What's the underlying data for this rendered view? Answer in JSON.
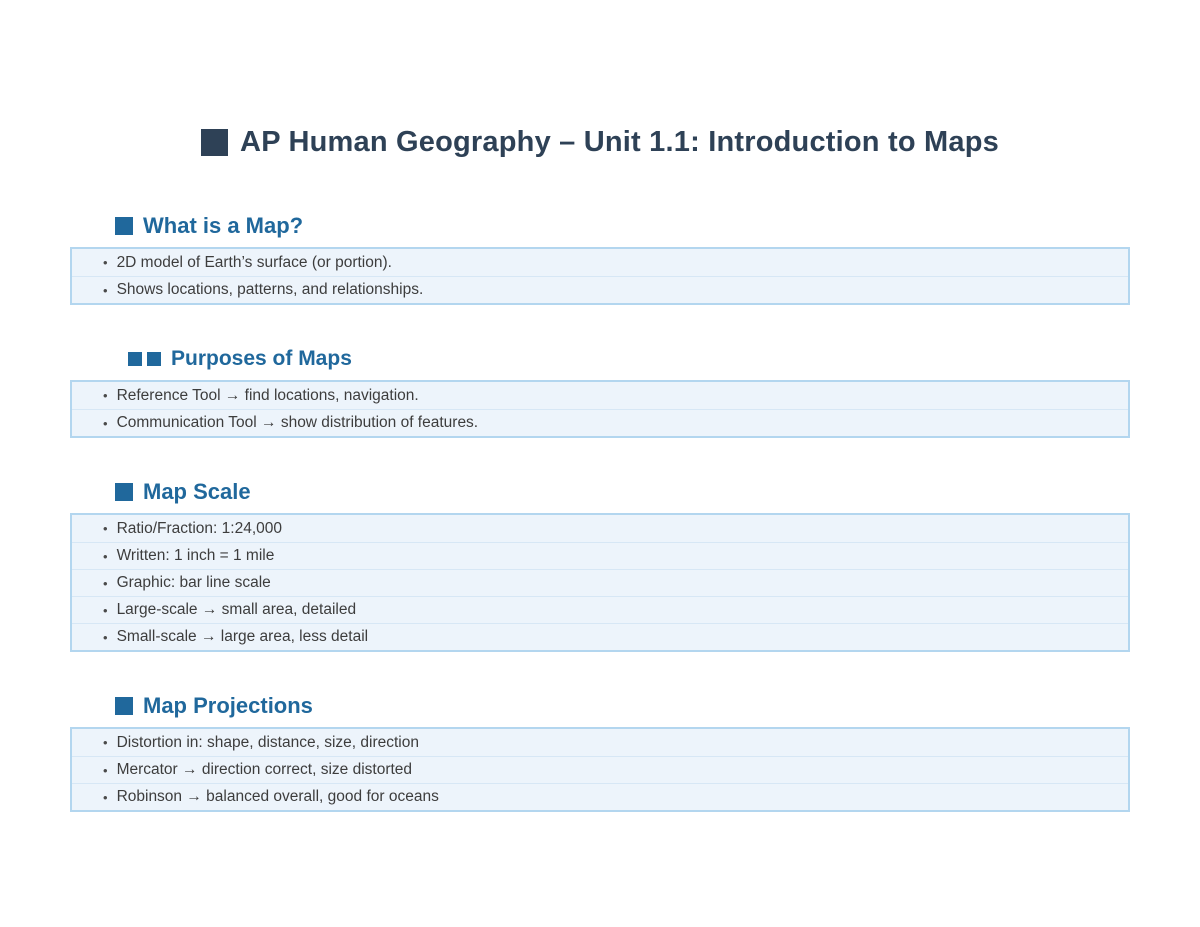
{
  "title": {
    "text": "AP Human Geography – Unit 1.1: Introduction to Maps"
  },
  "list": {
    "bullet": "•"
  },
  "colors": {
    "title_text": "#2e4156",
    "heading_text": "#20689c",
    "card_background": "#edf4fb",
    "card_border": "#b3d6ef",
    "card_divider": "#d7e7f5",
    "item_text": "#3d3d3d"
  },
  "sections": [
    {
      "heading": "What is a Map?",
      "marker_squares": 1,
      "items": [
        "2D model of Earth’s surface (or portion).",
        "Shows locations, patterns, and relationships."
      ]
    },
    {
      "heading": "Purposes of Maps",
      "marker_squares": 2,
      "items": [
        "Reference Tool → find locations, navigation.",
        "Communication Tool → show distribution of features."
      ]
    },
    {
      "heading": "Map Scale",
      "marker_squares": 1,
      "items": [
        "Ratio/Fraction: 1:24,000",
        "Written: 1 inch = 1 mile",
        "Graphic: bar line scale",
        "Large-scale → small area, detailed",
        "Small-scale → large area, less detail"
      ]
    },
    {
      "heading": "Map Projections",
      "marker_squares": 1,
      "items": [
        "Distortion in: shape, distance, size, direction",
        "Mercator → direction correct, size distorted",
        "Robinson → balanced overall, good for oceans"
      ]
    }
  ]
}
